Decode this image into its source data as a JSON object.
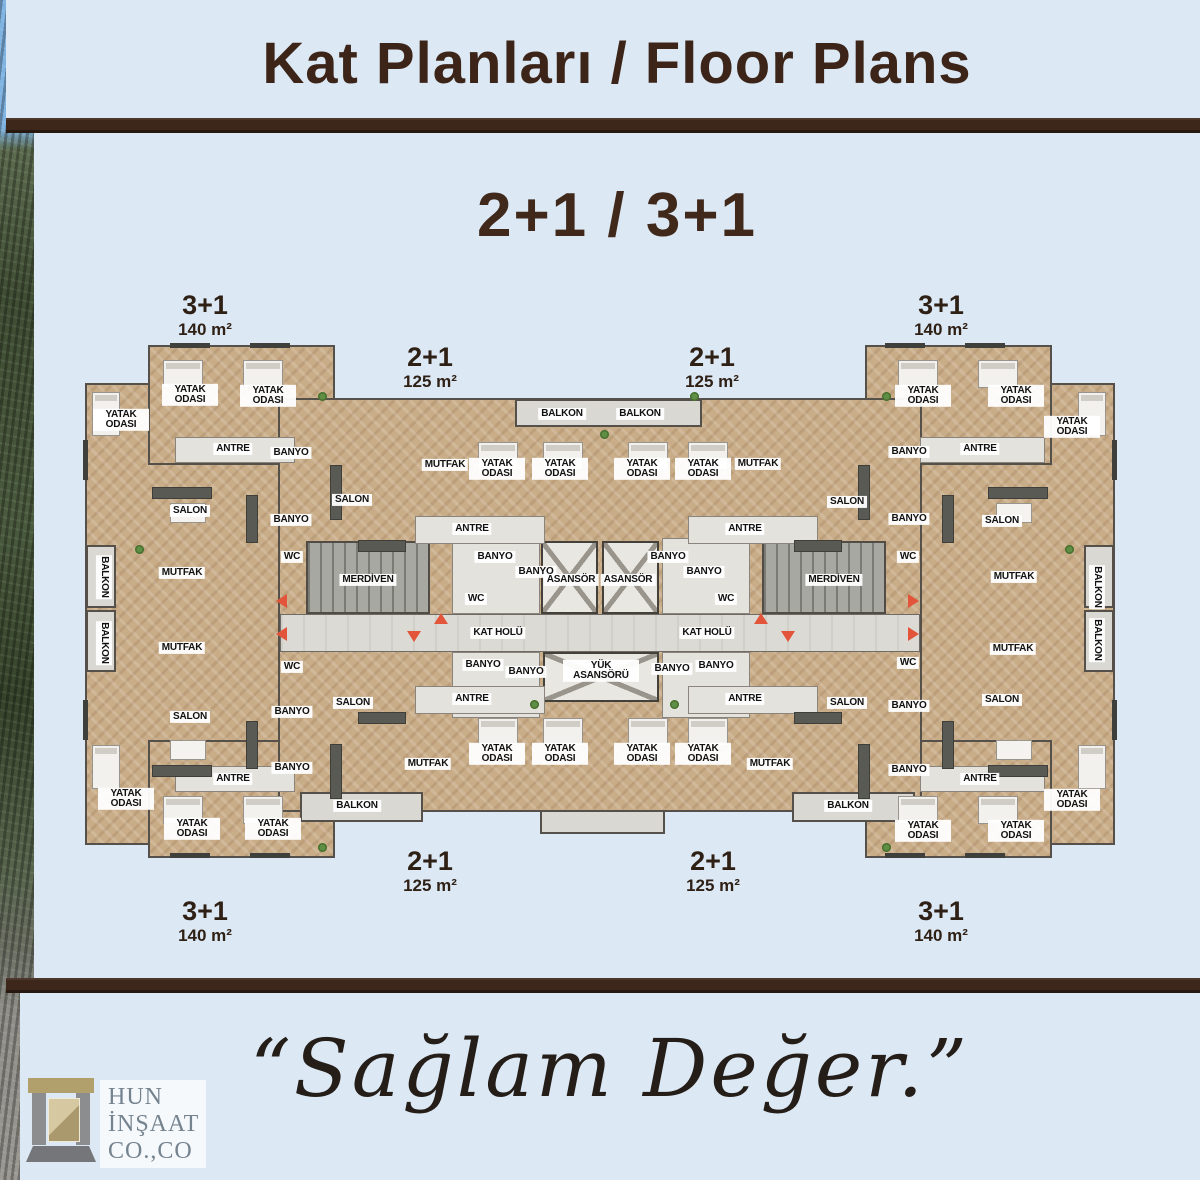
{
  "header": {
    "title": "Kat Planları / Floor Plans",
    "subtitle": "2+1 / 3+1"
  },
  "footer": {
    "tagline": "“Sağlam Değer.”",
    "logo": {
      "line1": "HUN",
      "line2": "İNŞAAT",
      "line3": "CO.,CO"
    }
  },
  "colors": {
    "background": "#dce9f5",
    "accent_brown": "#3d261a",
    "title_brown": "#3c2518",
    "wood": "#c9ad88",
    "arrow_red": "#e2553a"
  },
  "floor_plan": {
    "unit_labels": [
      {
        "type": "3+1",
        "area": "140 m²",
        "x": 205,
        "y": 292
      },
      {
        "type": "2+1",
        "area": "125 m²",
        "x": 430,
        "y": 344
      },
      {
        "type": "2+1",
        "area": "125 m²",
        "x": 712,
        "y": 344
      },
      {
        "type": "3+1",
        "area": "140 m²",
        "x": 941,
        "y": 292
      },
      {
        "type": "3+1",
        "area": "140 m²",
        "x": 205,
        "y": 898
      },
      {
        "type": "2+1",
        "area": "125 m²",
        "x": 430,
        "y": 848
      },
      {
        "type": "2+1",
        "area": "125 m²",
        "x": 713,
        "y": 848
      },
      {
        "type": "3+1",
        "area": "140 m²",
        "x": 941,
        "y": 898
      }
    ],
    "room_labels": [
      {
        "t": "YATAK ODASI",
        "x": 190,
        "y": 395,
        "w": 50
      },
      {
        "t": "YATAK ODASI",
        "x": 268,
        "y": 396,
        "w": 50
      },
      {
        "t": "YATAK ODASI",
        "x": 121,
        "y": 420,
        "w": 50
      },
      {
        "t": "ANTRE",
        "x": 233,
        "y": 449
      },
      {
        "t": "BANYO",
        "x": 291,
        "y": 453
      },
      {
        "t": "SALON",
        "x": 190,
        "y": 511
      },
      {
        "t": "BANYO",
        "x": 291,
        "y": 520
      },
      {
        "t": "WC",
        "x": 292,
        "y": 557
      },
      {
        "t": "MUTFAK",
        "x": 182,
        "y": 573
      },
      {
        "t": "BALKON",
        "x": 104,
        "y": 577,
        "v": true
      },
      {
        "t": "MERDİVEN",
        "x": 368,
        "y": 580
      },
      {
        "t": "SALON",
        "x": 352,
        "y": 500
      },
      {
        "t": "MUTFAK",
        "x": 445,
        "y": 465
      },
      {
        "t": "BALKON",
        "x": 562,
        "y": 414
      },
      {
        "t": "BALKON",
        "x": 640,
        "y": 414
      },
      {
        "t": "YATAK ODASI",
        "x": 497,
        "y": 469,
        "w": 50
      },
      {
        "t": "YATAK ODASI",
        "x": 560,
        "y": 469,
        "w": 50
      },
      {
        "t": "YATAK ODASI",
        "x": 642,
        "y": 469,
        "w": 50
      },
      {
        "t": "YATAK ODASI",
        "x": 703,
        "y": 469,
        "w": 50
      },
      {
        "t": "MUTFAK",
        "x": 758,
        "y": 464
      },
      {
        "t": "ANTRE",
        "x": 472,
        "y": 529
      },
      {
        "t": "ANTRE",
        "x": 745,
        "y": 529
      },
      {
        "t": "BANYO",
        "x": 495,
        "y": 557
      },
      {
        "t": "BANYO",
        "x": 536,
        "y": 572
      },
      {
        "t": "BANYO",
        "x": 668,
        "y": 557
      },
      {
        "t": "BANYO",
        "x": 704,
        "y": 572
      },
      {
        "t": "ASANSÖR",
        "x": 571,
        "y": 580
      },
      {
        "t": "ASANSÖR",
        "x": 628,
        "y": 580
      },
      {
        "t": "WC",
        "x": 476,
        "y": 599
      },
      {
        "t": "WC",
        "x": 726,
        "y": 599
      },
      {
        "t": "SALON",
        "x": 847,
        "y": 502
      },
      {
        "t": "BANYO",
        "x": 909,
        "y": 452
      },
      {
        "t": "ANTRE",
        "x": 980,
        "y": 449
      },
      {
        "t": "YATAK ODASI",
        "x": 923,
        "y": 396,
        "w": 50
      },
      {
        "t": "YATAK ODASI",
        "x": 1016,
        "y": 396,
        "w": 50
      },
      {
        "t": "YATAK ODASI",
        "x": 1072,
        "y": 427,
        "w": 50
      },
      {
        "t": "BANYO",
        "x": 909,
        "y": 519
      },
      {
        "t": "SALON",
        "x": 1002,
        "y": 521
      },
      {
        "t": "WC",
        "x": 908,
        "y": 557
      },
      {
        "t": "MUTFAK",
        "x": 1014,
        "y": 577
      },
      {
        "t": "MERDİVEN",
        "x": 834,
        "y": 580
      },
      {
        "t": "BALKON",
        "x": 1097,
        "y": 587,
        "v": true
      },
      {
        "t": "KAT HOLÜ",
        "x": 498,
        "y": 633
      },
      {
        "t": "KAT HOLÜ",
        "x": 707,
        "y": 633
      },
      {
        "t": "YÜK ASANSÖRÜ",
        "x": 601,
        "y": 671,
        "w": 70
      },
      {
        "t": "BALKON",
        "x": 104,
        "y": 643,
        "v": true
      },
      {
        "t": "MUTFAK",
        "x": 182,
        "y": 648
      },
      {
        "t": "WC",
        "x": 292,
        "y": 667
      },
      {
        "t": "BANYO",
        "x": 292,
        "y": 712
      },
      {
        "t": "SALON",
        "x": 190,
        "y": 717
      },
      {
        "t": "BANYO",
        "x": 292,
        "y": 768
      },
      {
        "t": "ANTRE",
        "x": 233,
        "y": 779
      },
      {
        "t": "YATAK ODASI",
        "x": 126,
        "y": 799,
        "w": 50
      },
      {
        "t": "YATAK ODASI",
        "x": 192,
        "y": 829,
        "w": 50
      },
      {
        "t": "YATAK ODASI",
        "x": 273,
        "y": 829,
        "w": 50
      },
      {
        "t": "BALKON",
        "x": 357,
        "y": 806
      },
      {
        "t": "SALON",
        "x": 353,
        "y": 703
      },
      {
        "t": "BANYO",
        "x": 483,
        "y": 665
      },
      {
        "t": "BANYO",
        "x": 526,
        "y": 672
      },
      {
        "t": "ANTRE",
        "x": 472,
        "y": 699
      },
      {
        "t": "MUTFAK",
        "x": 428,
        "y": 764
      },
      {
        "t": "YATAK ODASI",
        "x": 497,
        "y": 754,
        "w": 50
      },
      {
        "t": "YATAK ODASI",
        "x": 560,
        "y": 754,
        "w": 50
      },
      {
        "t": "YATAK ODASI",
        "x": 642,
        "y": 754,
        "w": 50
      },
      {
        "t": "YATAK ODASI",
        "x": 703,
        "y": 754,
        "w": 50
      },
      {
        "t": "BANYO",
        "x": 672,
        "y": 669
      },
      {
        "t": "BANYO",
        "x": 716,
        "y": 666
      },
      {
        "t": "ANTRE",
        "x": 745,
        "y": 699
      },
      {
        "t": "MUTFAK",
        "x": 770,
        "y": 764
      },
      {
        "t": "SALON",
        "x": 847,
        "y": 703
      },
      {
        "t": "BALKON",
        "x": 848,
        "y": 806
      },
      {
        "t": "MUTFAK",
        "x": 1013,
        "y": 649
      },
      {
        "t": "WC",
        "x": 908,
        "y": 663
      },
      {
        "t": "BANYO",
        "x": 909,
        "y": 706
      },
      {
        "t": "SALON",
        "x": 1002,
        "y": 700
      },
      {
        "t": "BANYO",
        "x": 909,
        "y": 770
      },
      {
        "t": "ANTRE",
        "x": 980,
        "y": 779
      },
      {
        "t": "YATAK ODASI",
        "x": 923,
        "y": 831,
        "w": 50
      },
      {
        "t": "YATAK ODASI",
        "x": 1016,
        "y": 831,
        "w": 50
      },
      {
        "t": "YATAK ODASI",
        "x": 1072,
        "y": 800,
        "w": 50
      },
      {
        "t": "BALKON",
        "x": 1097,
        "y": 640,
        "v": true
      }
    ]
  }
}
